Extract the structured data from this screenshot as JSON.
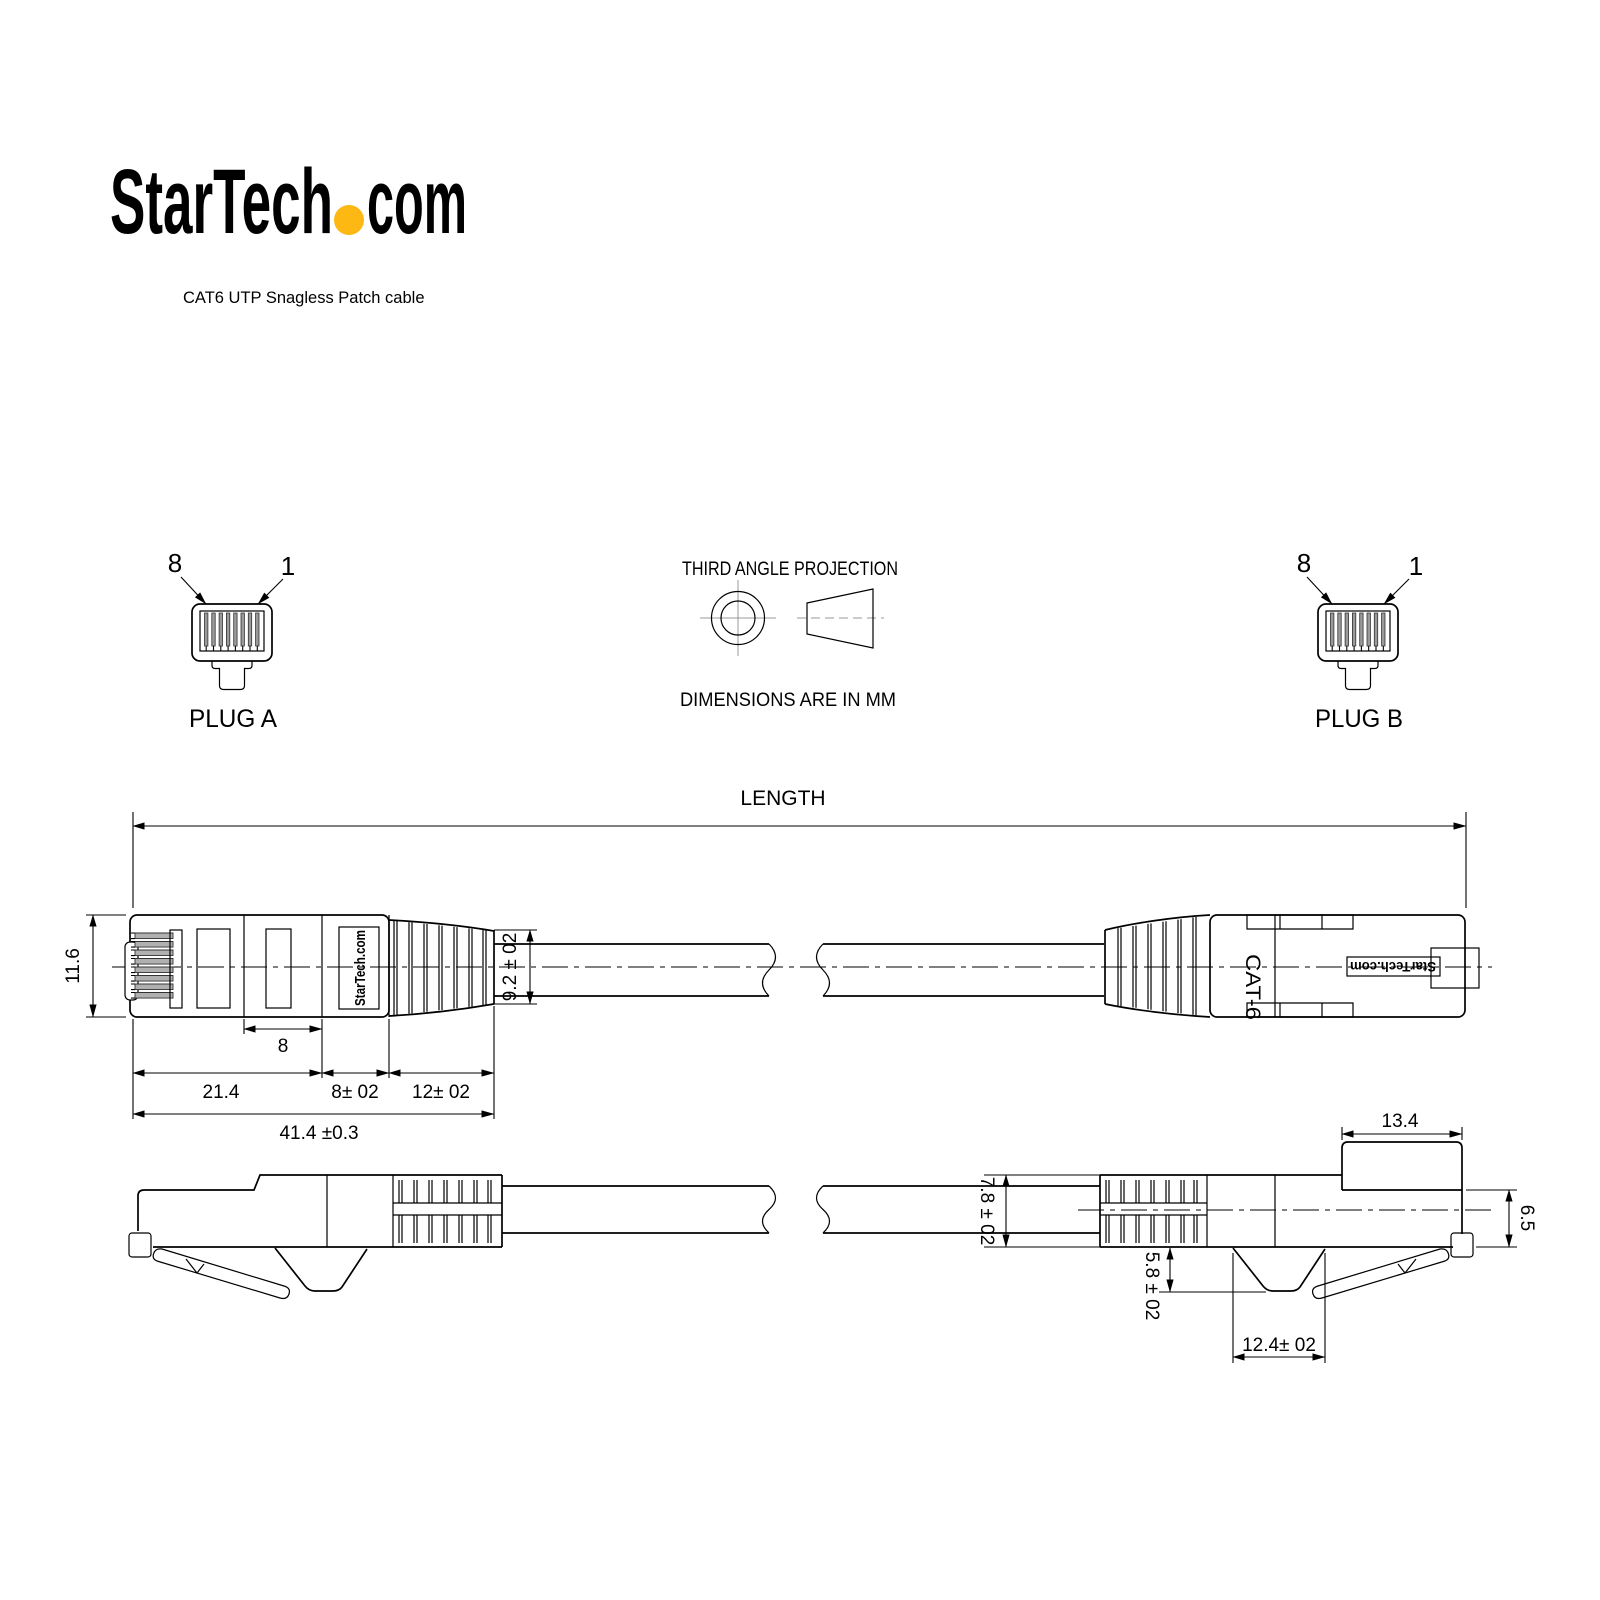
{
  "page": {
    "background": "#ffffff",
    "line_color": "#000000"
  },
  "logo": {
    "text_main": "StarTech",
    "text_suffix": "com",
    "dot_color": "#FDB813"
  },
  "subtitle": "CAT6 UTP Snagless Patch cable",
  "projection_note": {
    "title": "THIRD ANGLE PROJECTION",
    "units": "DIMENSIONS ARE IN MM"
  },
  "plug_a": {
    "label": "PLUG A",
    "pin_left": "8",
    "pin_right": "1"
  },
  "plug_b": {
    "label": "PLUG B",
    "pin_left": "8",
    "pin_right": "1"
  },
  "side_view": {
    "length_label": "LENGTH",
    "connector_height": "11.6",
    "boot_end_diameter": "9.2 ± 02",
    "latch_window_length": "8",
    "body_length": "21.4",
    "boot_length": "8± 02",
    "strain_relief_length": "12± 02",
    "overall_connector_length": "41.4 ±0.3",
    "left_marking": "StarTech.com",
    "right_marking_cable": "CAT-6",
    "right_marking_brand": "StarTech.com"
  },
  "bottom_view": {
    "contact_step_length": "13.4",
    "boot_height": "7.8 ± 02",
    "front_height": "6.5",
    "hook_depth": "5.8 ± 02",
    "hook_width": "12.4± 02"
  }
}
